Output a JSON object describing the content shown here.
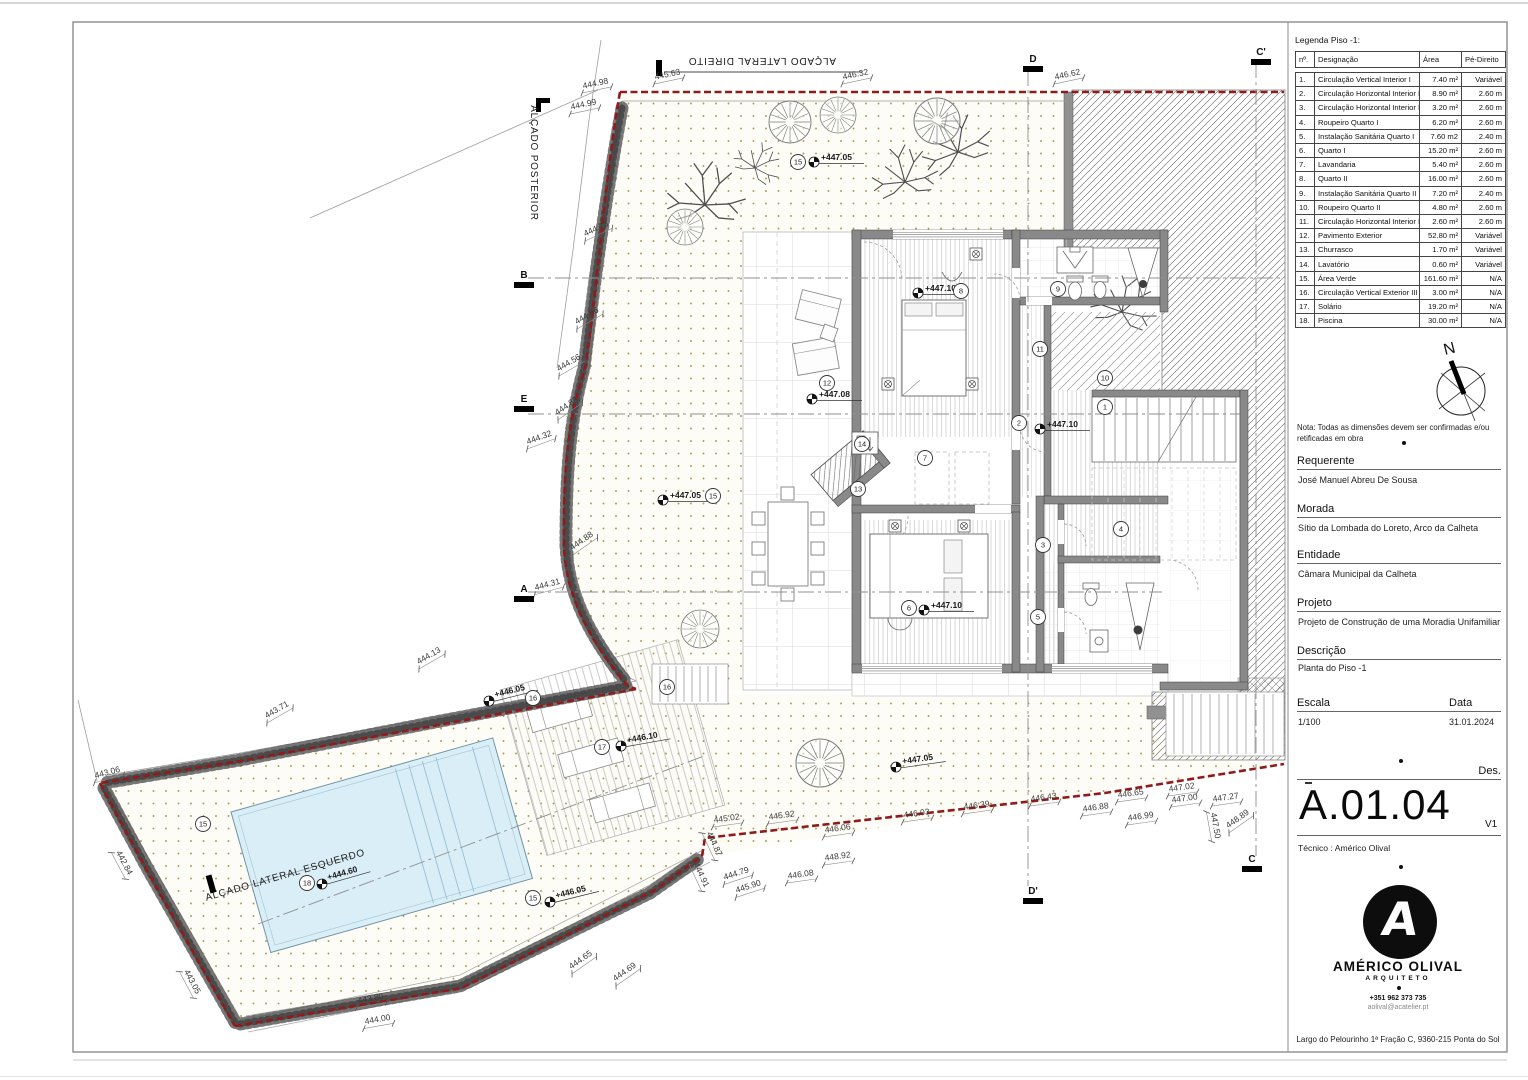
{
  "legend": {
    "title": "Legenda Piso -1:",
    "headers": {
      "num": "nº.",
      "designation": "Designação",
      "area": "Área",
      "height": "Pé-Direito"
    },
    "rows": [
      {
        "num": "1.",
        "designation": "Circulação Vertical Interior I",
        "area": "7.40 m²",
        "height": "Variável"
      },
      {
        "num": "2.",
        "designation": "Circulação Horizontal Interior II",
        "area": "8.90 m²",
        "height": "2.60 m"
      },
      {
        "num": "3.",
        "designation": "Circulação Horizontal Interior III",
        "area": "3.20 m²",
        "height": "2.60 m"
      },
      {
        "num": "4.",
        "designation": "Roupeiro Quarto I",
        "area": "6.20 m²",
        "height": "2.60 m"
      },
      {
        "num": "5.",
        "designation": "Instalação Sanitária Quarto I",
        "area": "7.60 m2",
        "height": "2.40 m"
      },
      {
        "num": "6.",
        "designation": "Quarto I",
        "area": "15.20 m²",
        "height": "2.60 m"
      },
      {
        "num": "7.",
        "designation": "Lavandaria",
        "area": "5.40 m²",
        "height": "2.60 m"
      },
      {
        "num": "8.",
        "designation": "Quarto II",
        "area": "16.00 m²",
        "height": "2.60 m"
      },
      {
        "num": "9.",
        "designation": "Instalação Sanitária Quarto II",
        "area": "7.20 m²",
        "height": "2.40 m"
      },
      {
        "num": "10.",
        "designation": "Roupeiro Quarto II",
        "area": "4.80 m²",
        "height": "2.60 m"
      },
      {
        "num": "11.",
        "designation": "Circulação Horizontal Interior IV",
        "area": "2.60 m²",
        "height": "2.60 m"
      },
      {
        "num": "12.",
        "designation": "Pavimento Exterior",
        "area": "52.80 m²",
        "height": "Variável"
      },
      {
        "num": "13.",
        "designation": "Churrasco",
        "area": "1.70 m²",
        "height": "Variável"
      },
      {
        "num": "14.",
        "designation": "Lavatório",
        "area": "0.60 m²",
        "height": "Variável"
      },
      {
        "num": "15.",
        "designation": "Área Verde",
        "area": "161.60 m²",
        "height": "N/A"
      },
      {
        "num": "16.",
        "designation": "Circulação Vertical Exterior III",
        "area": "3.00 m²",
        "height": "N/A"
      },
      {
        "num": "17.",
        "designation": "Solário",
        "area": "19.20 m²",
        "height": "N/A"
      },
      {
        "num": "18.",
        "designation": "Piscina",
        "area": "30.00 m²",
        "height": "N/A"
      }
    ]
  },
  "titleblock": {
    "north_label": "N",
    "nota": "Nota: Todas as dimensões devem ser confirmadas e/ou retificadas em obra",
    "requerente_label": "Requerente",
    "requerente": "José Manuel Abreu De Sousa",
    "morada_label": "Morada",
    "morada": "Sítio da Lombada do Loreto, Arco da Calheta",
    "entidade_label": "Entidade",
    "entidade": "Câmara Municipal da Calheta",
    "projeto_label": "Projeto",
    "projeto": "Projeto de Construção de uma Moradia Unifamiliar",
    "descricao_label": "Descrição",
    "descricao": "Planta do Piso -1",
    "escala_label": "Escala",
    "escala": "1/100",
    "data_label": "Data",
    "data": "31.01.2024",
    "des_label": "Des.",
    "sheet_code": "A.01.04",
    "version": "V1",
    "tecnico": "Técnico : Américo Olival"
  },
  "logo": {
    "monogram": "A",
    "name": "AMÉRICO OLIVAL",
    "role": "ARQUITETO",
    "phone": "+351 962 373 735",
    "email": "aolival@acatelier.pt",
    "address": "Largo do Pelourinho 1ª Fração C, 9360-215 Ponta do Sol"
  },
  "plan": {
    "labels": [
      {
        "t": "ALÇADO LATERAL DIREITO",
        "x": 762,
        "y": 58,
        "r": 180
      },
      {
        "t": "ALÇADO POSTERIOR",
        "x": 531,
        "y": 163,
        "r": 90
      },
      {
        "t": "ALÇADO LATERAL ESQUERDO",
        "x": 286,
        "y": 878,
        "r": -16
      }
    ],
    "dims": [
      {
        "t": "445.63",
        "x": 668,
        "y": 77,
        "r": -12
      },
      {
        "t": "444.98",
        "x": 596,
        "y": 86,
        "r": -12
      },
      {
        "t": "444.99",
        "x": 584,
        "y": 107,
        "r": -12
      },
      {
        "t": "446.32",
        "x": 856,
        "y": 77,
        "r": -12
      },
      {
        "t": "446.62",
        "x": 1068,
        "y": 77,
        "r": -12
      },
      {
        "t": "444.73",
        "x": 597,
        "y": 231,
        "r": -25
      },
      {
        "t": "444.66",
        "x": 588,
        "y": 318,
        "r": -30
      },
      {
        "t": "444.56",
        "x": 570,
        "y": 365,
        "r": -30
      },
      {
        "t": "444.83",
        "x": 568,
        "y": 408,
        "r": -35
      },
      {
        "t": "444.32",
        "x": 540,
        "y": 440,
        "r": -20
      },
      {
        "t": "444.88",
        "x": 583,
        "y": 543,
        "r": -35
      },
      {
        "t": "444.31",
        "x": 548,
        "y": 587,
        "r": -15
      },
      {
        "t": "444.13",
        "x": 430,
        "y": 658,
        "r": -30
      },
      {
        "t": "443.71",
        "x": 278,
        "y": 712,
        "r": -30
      },
      {
        "t": "443.06",
        "x": 108,
        "y": 775,
        "r": -15
      },
      {
        "t": "442.84",
        "x": 122,
        "y": 864,
        "r": 62
      },
      {
        "t": "443.05",
        "x": 190,
        "y": 983,
        "r": 62
      },
      {
        "t": "443.89",
        "x": 371,
        "y": 1001,
        "r": -10
      },
      {
        "t": "444.00",
        "x": 378,
        "y": 1022,
        "r": -10
      },
      {
        "t": "444.65",
        "x": 582,
        "y": 962,
        "r": -35
      },
      {
        "t": "444.69",
        "x": 626,
        "y": 974,
        "r": -35
      },
      {
        "t": "444.87",
        "x": 712,
        "y": 845,
        "r": 65
      },
      {
        "t": "444.91",
        "x": 699,
        "y": 876,
        "r": 65
      },
      {
        "t": "444.79",
        "x": 737,
        "y": 876,
        "r": -18
      },
      {
        "t": "445.90",
        "x": 749,
        "y": 889,
        "r": -18
      },
      {
        "t": "446.08",
        "x": 801,
        "y": 877,
        "r": -8
      },
      {
        "t": "448.92",
        "x": 838,
        "y": 859,
        "r": -8
      },
      {
        "t": "446.06",
        "x": 838,
        "y": 831,
        "r": -8
      },
      {
        "t": "445.02",
        "x": 727,
        "y": 821,
        "r": -8
      },
      {
        "t": "445.92",
        "x": 782,
        "y": 818,
        "r": -8
      },
      {
        "t": "446.03",
        "x": 917,
        "y": 816,
        "r": -8
      },
      {
        "t": "446.39",
        "x": 977,
        "y": 808,
        "r": -8
      },
      {
        "t": "446.43",
        "x": 1044,
        "y": 800,
        "r": -8
      },
      {
        "t": "446.88",
        "x": 1096,
        "y": 810,
        "r": -8
      },
      {
        "t": "446.65",
        "x": 1131,
        "y": 796,
        "r": -8
      },
      {
        "t": "446.99",
        "x": 1141,
        "y": 819,
        "r": -8
      },
      {
        "t": "447.02",
        "x": 1182,
        "y": 790,
        "r": -8
      },
      {
        "t": "447.00",
        "x": 1185,
        "y": 801,
        "r": -8
      },
      {
        "t": "447.27",
        "x": 1226,
        "y": 800,
        "r": -8
      },
      {
        "t": "447.50",
        "x": 1213,
        "y": 826,
        "r": 80
      },
      {
        "t": "448.89",
        "x": 1239,
        "y": 821,
        "r": -35
      }
    ],
    "marks": [
      {
        "t": "+447.05",
        "x": 814,
        "y": 162,
        "r": 0
      },
      {
        "t": "+447.05",
        "x": 663,
        "y": 500,
        "r": 0
      },
      {
        "t": "+447.08",
        "x": 812,
        "y": 399,
        "r": 0
      },
      {
        "t": "+447.10",
        "x": 918,
        "y": 293,
        "r": 0
      },
      {
        "t": "+447.10",
        "x": 1040,
        "y": 429,
        "r": 0
      },
      {
        "t": "+447.10",
        "x": 924,
        "y": 610,
        "r": 0
      },
      {
        "t": "+446.05",
        "x": 489,
        "y": 701,
        "r": -14
      },
      {
        "t": "+446.10",
        "x": 621,
        "y": 746,
        "r": -10
      },
      {
        "t": "+446.05",
        "x": 550,
        "y": 902,
        "r": -14
      },
      {
        "t": "+444.60",
        "x": 322,
        "y": 884,
        "r": -16
      },
      {
        "t": "+447.05",
        "x": 896,
        "y": 767,
        "r": -8
      }
    ],
    "circles": [
      {
        "n": "15",
        "x": 798,
        "y": 162
      },
      {
        "n": "15",
        "x": 713,
        "y": 496
      },
      {
        "n": "12",
        "x": 827,
        "y": 383
      },
      {
        "n": "8",
        "x": 961,
        "y": 291
      },
      {
        "n": "2",
        "x": 1019,
        "y": 423
      },
      {
        "n": "6",
        "x": 909,
        "y": 608
      },
      {
        "n": "11",
        "x": 1040,
        "y": 349
      },
      {
        "n": "9",
        "x": 1058,
        "y": 289
      },
      {
        "n": "10",
        "x": 1105,
        "y": 378
      },
      {
        "n": "1",
        "x": 1105,
        "y": 407
      },
      {
        "n": "7",
        "x": 925,
        "y": 458
      },
      {
        "n": "13",
        "x": 858,
        "y": 489
      },
      {
        "n": "14",
        "x": 862,
        "y": 444
      },
      {
        "n": "3",
        "x": 1043,
        "y": 545
      },
      {
        "n": "4",
        "x": 1121,
        "y": 529
      },
      {
        "n": "5",
        "x": 1038,
        "y": 617
      },
      {
        "n": "16",
        "x": 533,
        "y": 698
      },
      {
        "n": "17",
        "x": 602,
        "y": 747
      },
      {
        "n": "15",
        "x": 533,
        "y": 898
      },
      {
        "n": "18",
        "x": 307,
        "y": 883
      },
      {
        "n": "15",
        "x": 203,
        "y": 824
      },
      {
        "n": "16",
        "x": 667,
        "y": 687
      }
    ],
    "sections": [
      {
        "t": "D",
        "x": 1033,
        "y": 64
      },
      {
        "t": "D'",
        "x": 1033,
        "y": 896
      },
      {
        "t": "C'",
        "x": 1261,
        "y": 57
      },
      {
        "t": "C",
        "x": 1252,
        "y": 864
      },
      {
        "t": "B",
        "x": 524,
        "y": 280
      },
      {
        "t": "E",
        "x": 524,
        "y": 404
      },
      {
        "t": "A",
        "x": 524,
        "y": 594
      }
    ]
  }
}
